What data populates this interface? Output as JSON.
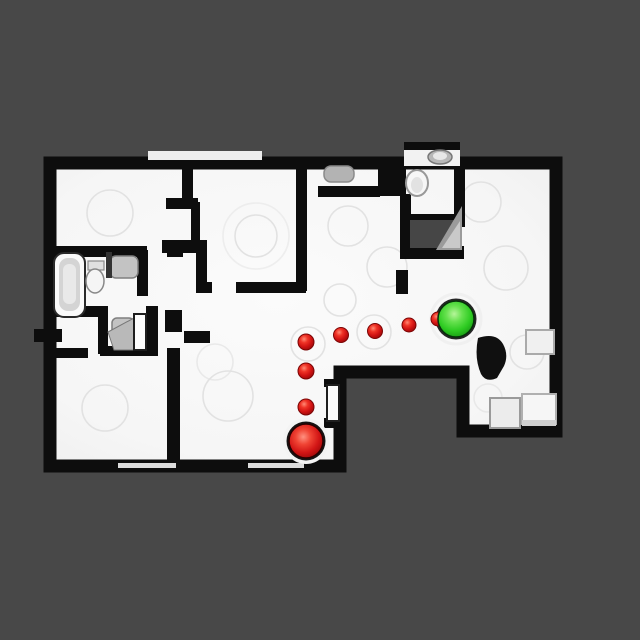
{
  "scene": {
    "type": "top-down-floorplan-scan",
    "description": "orthographic top-down view of a scanned apartment with a navigation path",
    "background_color": "#484848",
    "floor_color": "#f7f7f7",
    "wall_color": "#0d0d0d"
  },
  "navigation": {
    "path_color": "#d21414",
    "start": {
      "label": "start",
      "color": "#d21414",
      "x": 306,
      "y": 441,
      "radius": 17,
      "halo_radius": 23
    },
    "goal": {
      "label": "goal",
      "color": "#2fc41f",
      "x": 456,
      "y": 319,
      "radius": 18,
      "halo_radius": 25
    },
    "waypoints": [
      {
        "x": 306,
        "y": 407,
        "r": 8
      },
      {
        "x": 306,
        "y": 371,
        "r": 8
      },
      {
        "x": 306,
        "y": 342,
        "r": 8
      },
      {
        "x": 341,
        "y": 335,
        "r": 7.5
      },
      {
        "x": 375,
        "y": 331,
        "r": 7.5
      },
      {
        "x": 409,
        "y": 325,
        "r": 7
      },
      {
        "x": 438,
        "y": 319,
        "r": 7
      }
    ]
  },
  "fixtures": [
    "bathtub",
    "toilet",
    "vanity-sink",
    "wc-fixture",
    "kitchen-sink",
    "bathroom-toilet",
    "bathroom-sink",
    "closet-door",
    "open-door",
    "entry-steps"
  ]
}
